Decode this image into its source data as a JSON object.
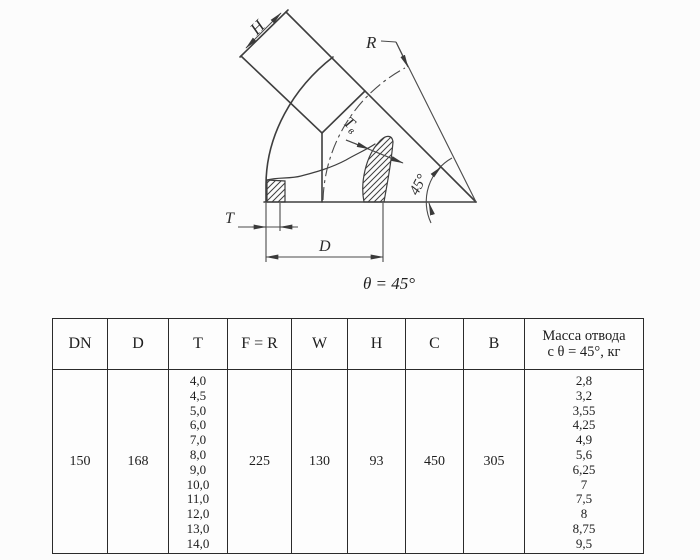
{
  "drawing": {
    "labels": {
      "h": "H",
      "r": "R",
      "t": "T",
      "d": "D",
      "tv_main": "T",
      "tv_sub": "в",
      "angle": "45°",
      "theta_caption": "θ = 45°"
    },
    "colors": {
      "line": "#3e3e3e",
      "thin_line": "#4a4a4a",
      "text": "#2b2b2b"
    }
  },
  "table": {
    "headers": [
      "DN",
      "D",
      "T",
      "F = R",
      "W",
      "H",
      "C",
      "B"
    ],
    "mass_header_line1": "Масса отвода",
    "mass_header_line2": "с θ = 45°, кг",
    "row": {
      "dn": "150",
      "d": "168",
      "t_values": [
        "4,0",
        "4,5",
        "5,0",
        "6,0",
        "7,0",
        "8,0",
        "9,0",
        "10,0",
        "11,0",
        "12,0",
        "13,0",
        "14,0"
      ],
      "f_r": "225",
      "w": "130",
      "h": "93",
      "c": "450",
      "b": "305",
      "mass_values": [
        "2,8",
        "3,2",
        "3,55",
        "4,25",
        "4,9",
        "5,6",
        "6,25",
        "7",
        "7,5",
        "8",
        "8,75",
        "9,5"
      ]
    }
  }
}
